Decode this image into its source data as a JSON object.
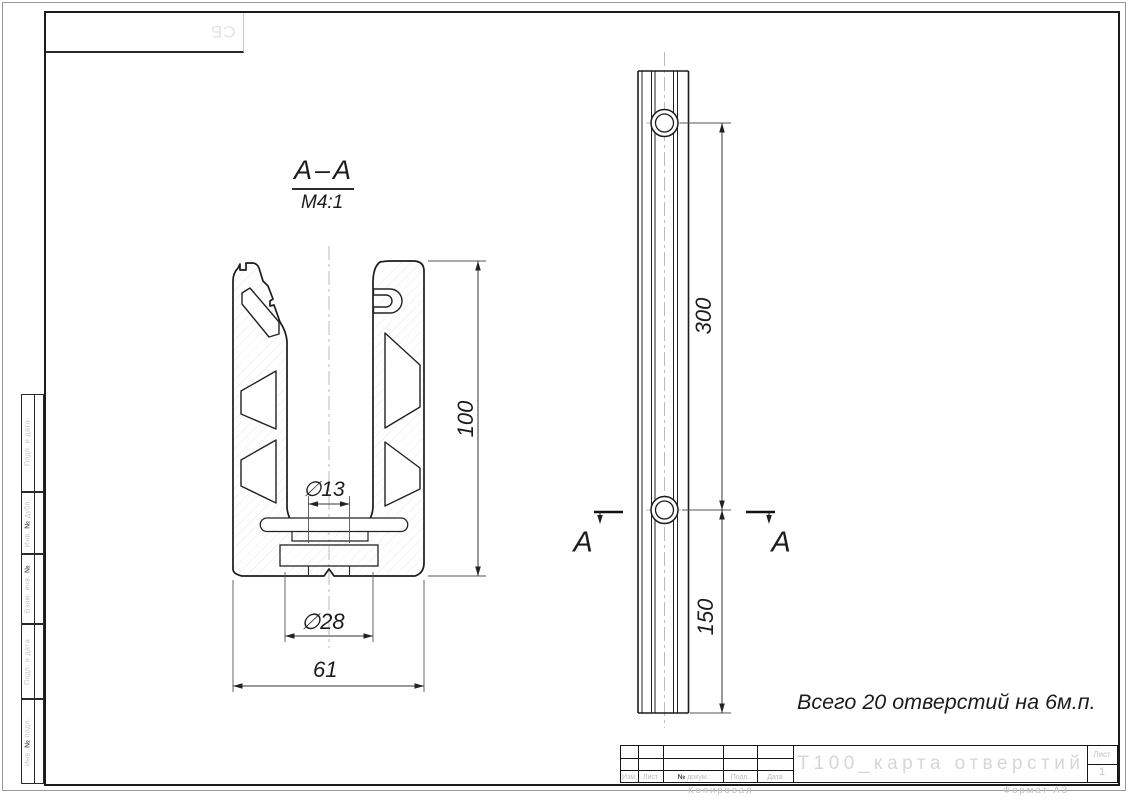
{
  "drawing": {
    "section": {
      "title": "А–А",
      "scale": "М4:1",
      "dim_height": "100",
      "dim_hole": "∅13",
      "dim_boss": "∅28",
      "dim_width": "61"
    },
    "side": {
      "dim_spacing": "300",
      "dim_end": "150",
      "cut_left": "А",
      "cut_right": "А"
    },
    "note": "Всего 20 отверстий на 6м.п."
  },
  "title_block": {
    "doc_title": "Т100_карта отверстий",
    "sheet_label": "Лист",
    "sheet_number": "1",
    "cols": {
      "izm": "Изм.",
      "list": "Лист",
      "no": "№",
      "dokum": "докум.",
      "podp": "Подп.",
      "data": "Дата"
    },
    "kopiroval": "Копировал",
    "format": "Формат А3"
  },
  "stamps": [
    {
      "pre": "Подп. и дата",
      "no": "",
      "post": ""
    },
    {
      "pre": "Инв. ",
      "no": "№",
      "post": " дубл."
    },
    {
      "pre": "Взам. инв. ",
      "no": "№",
      "post": ""
    },
    {
      "pre": "Подп. и дата",
      "no": "",
      "post": ""
    },
    {
      "pre": "Инв. ",
      "no": "№",
      "post": " подл."
    }
  ],
  "corner_stamp": "СБ"
}
